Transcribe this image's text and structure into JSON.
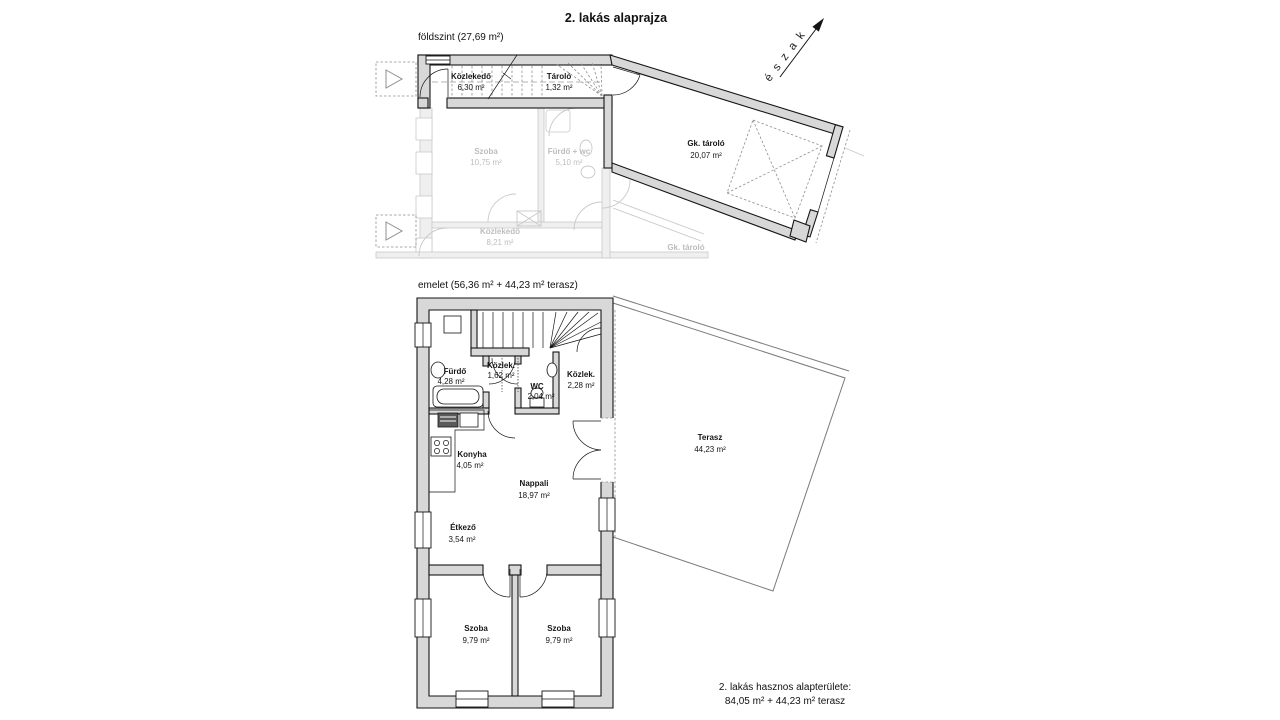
{
  "title": "2. lakás alaprajza",
  "north": {
    "label": "é s z a k"
  },
  "ground_floor": {
    "caption": "földszint (27,69 m²)",
    "rooms": [
      {
        "name": "Közlekedő",
        "area": "6,30 m²"
      },
      {
        "name": "Tároló",
        "area": "1,32 m²"
      },
      {
        "name": "Gk. tároló",
        "area": "20,07 m²"
      }
    ],
    "faded_rooms": [
      {
        "name": "Szoba",
        "area": "10,75 m²"
      },
      {
        "name": "Fürdő + wc",
        "area": "5,10 m²"
      },
      {
        "name": "Közlekedő",
        "area": "8,21 m²"
      },
      {
        "name": "Gk. tároló",
        "area": ""
      }
    ]
  },
  "upper_floor": {
    "caption": "emelet (56,36 m² + 44,23 m² terasz)",
    "rooms": [
      {
        "name": "Fürdő",
        "area": "4,28 m²"
      },
      {
        "name": "Közlek.",
        "area": "1,62 m²"
      },
      {
        "name": "WC",
        "area": "2,04 m²"
      },
      {
        "name": "Közlek.",
        "area": "2,28 m²"
      },
      {
        "name": "Konyha",
        "area": "4,05 m²"
      },
      {
        "name": "Nappali",
        "area": "18,97 m²"
      },
      {
        "name": "Étkező",
        "area": "3,54 m²"
      },
      {
        "name": "Szoba",
        "area": "9,79 m²"
      },
      {
        "name": "Szoba",
        "area": "9,79 m²"
      },
      {
        "name": "Terasz",
        "area": "44,23 m²"
      }
    ]
  },
  "summary": {
    "line1": "2. lakás hasznos alapterülete:",
    "line2": "84,05 m² + 44,23 m² terasz"
  },
  "colors": {
    "wall_fill": "#d8d8d8",
    "line": "#141414",
    "faded": "#c9c9c9",
    "background": "#ffffff"
  }
}
